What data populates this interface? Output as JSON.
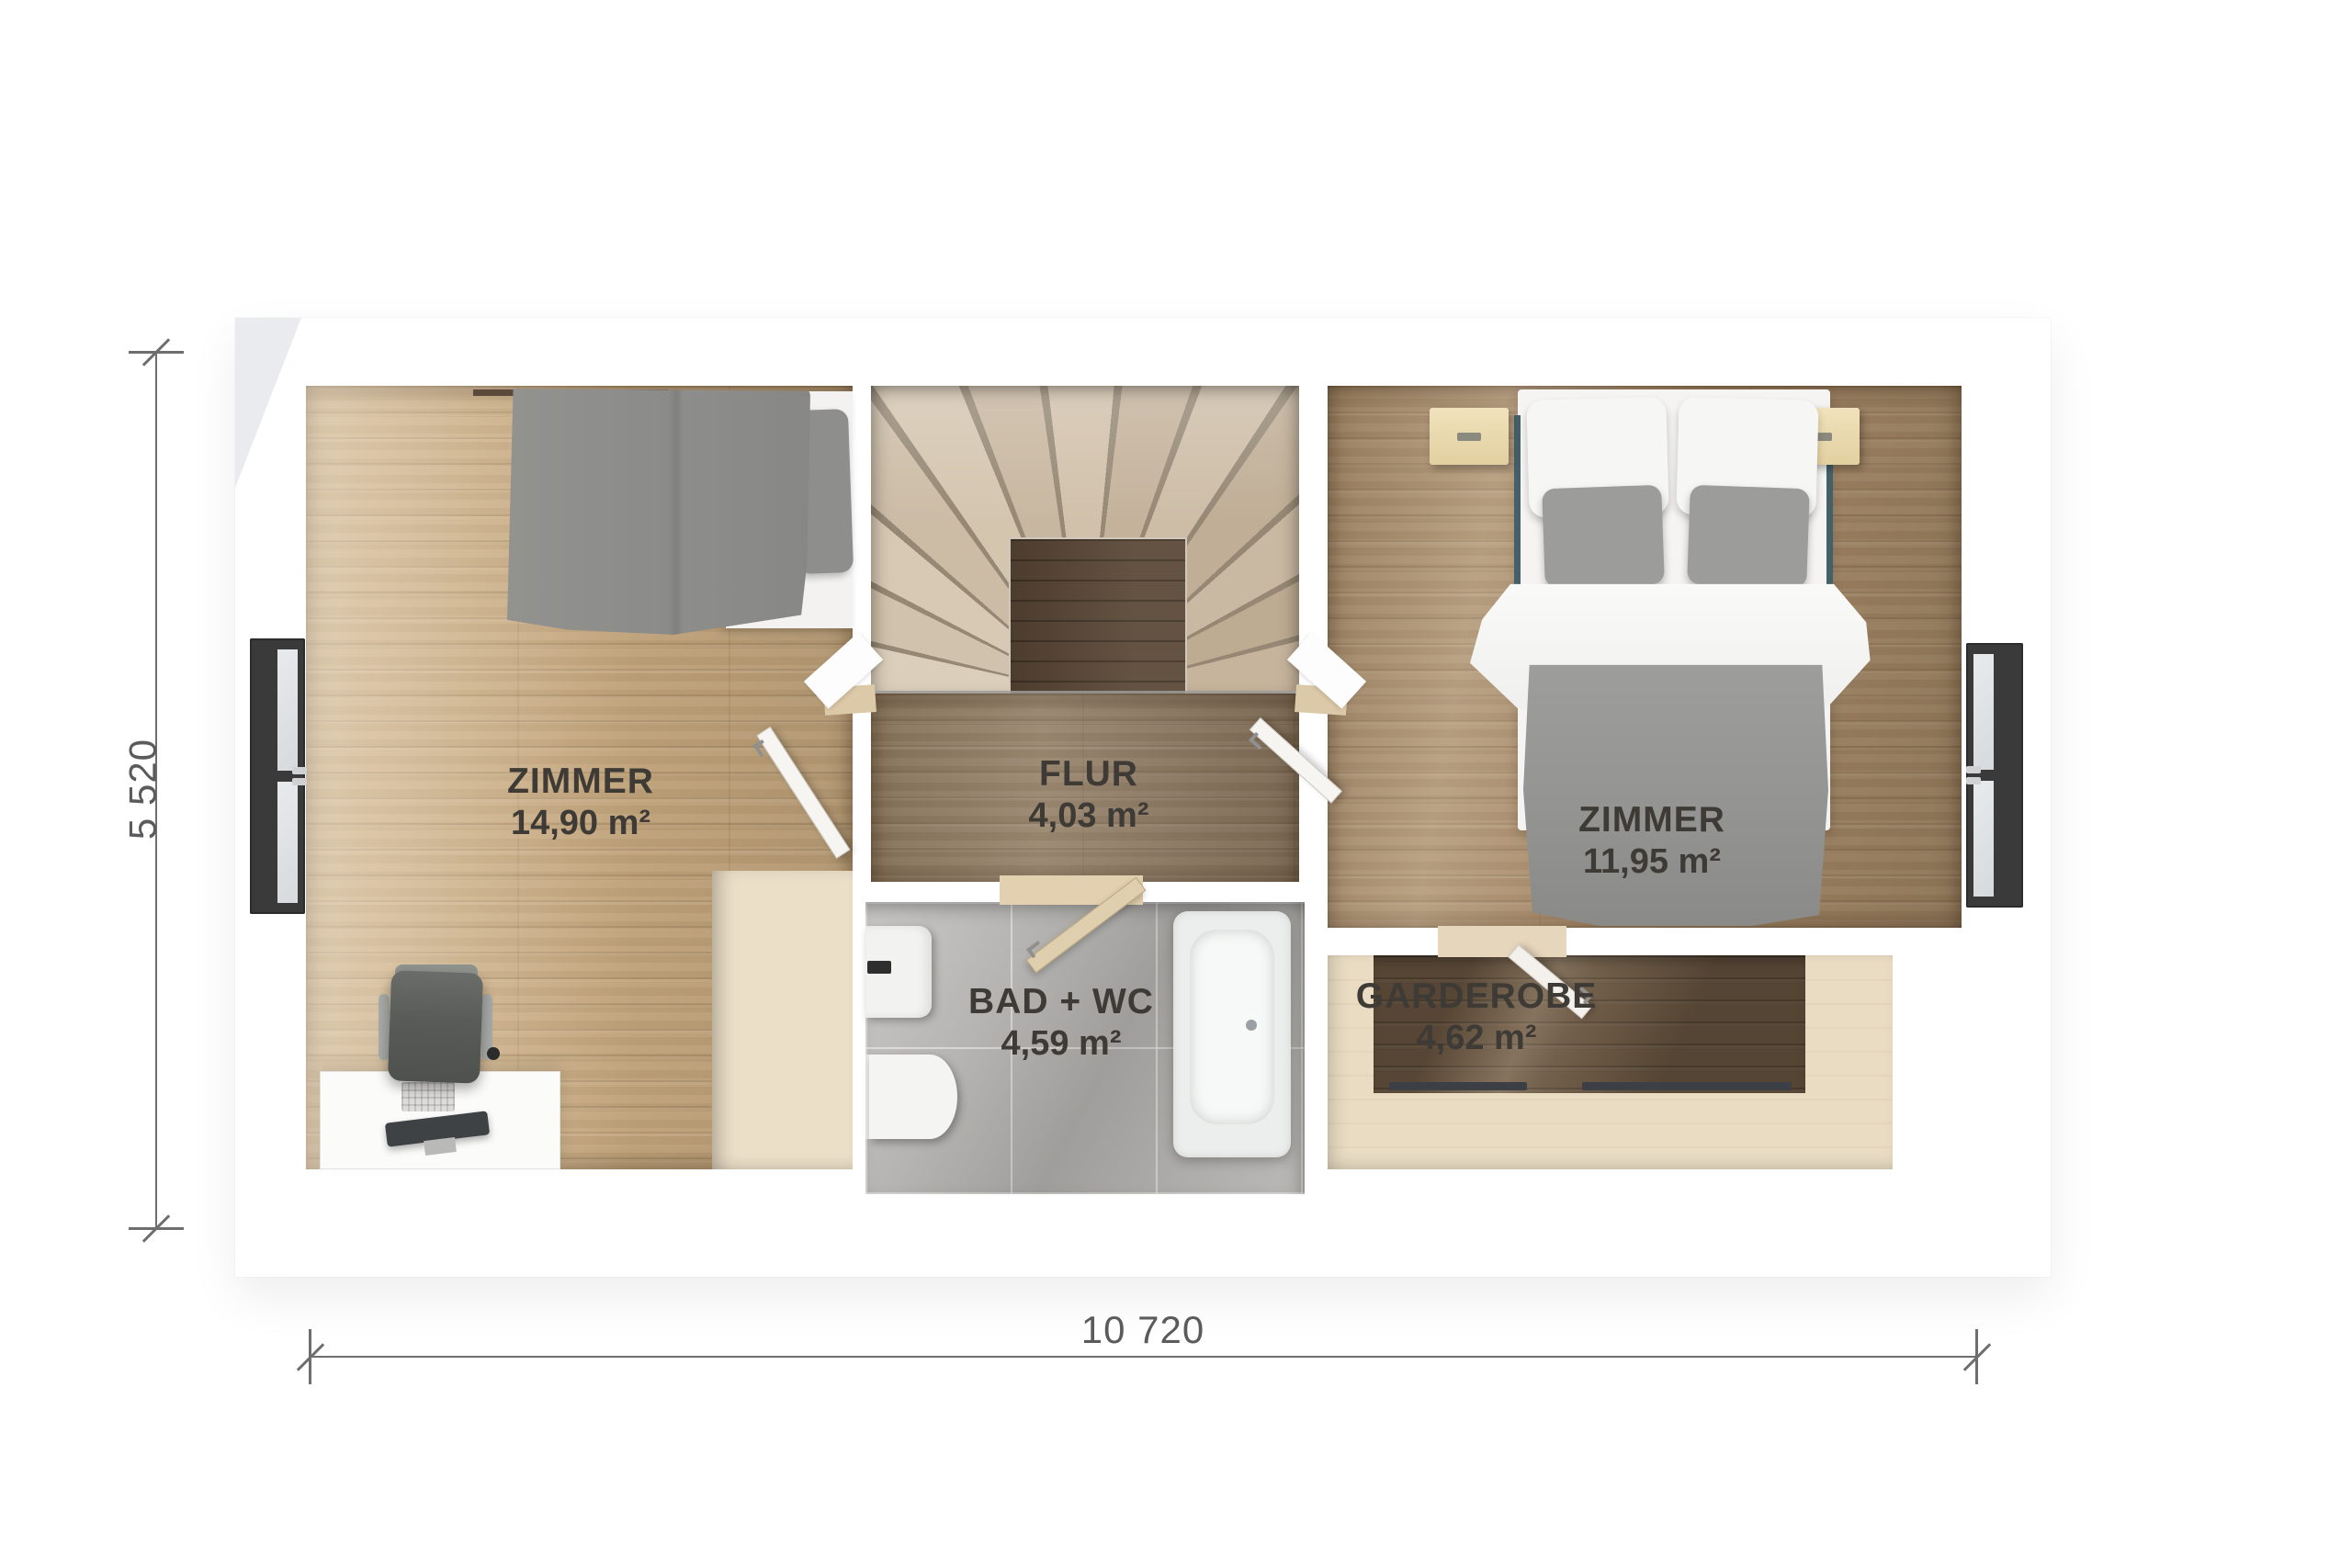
{
  "plan": {
    "title": "Obergeschoss Grundriss",
    "rooms": [
      {
        "key": "zimmer_left",
        "name": "ZIMMER",
        "area": "14,90 m²"
      },
      {
        "key": "flur",
        "name": "FLUR",
        "area": "4,03 m²"
      },
      {
        "key": "zimmer_right",
        "name": "ZIMMER",
        "area": "11,95 m²"
      },
      {
        "key": "bad_wc",
        "name": "BAD + WC",
        "area": "4,59 m²"
      },
      {
        "key": "garderobe",
        "name": "GARDEROBE",
        "area": "4,62 m²"
      }
    ],
    "dimensions": {
      "height": {
        "label": "5 520"
      },
      "width": {
        "label": "10 720"
      }
    },
    "colors": {
      "floor_light_oak": "#c6a87e",
      "floor_medium_oak": "#a98b68",
      "floor_hall": "#8f7a60",
      "floor_dark_walnut": "#63503c",
      "floor_storage_beige": "#e9dcc3",
      "tile_gray": "#b2b0ad",
      "stair_tread": "#d2c4ae",
      "stair_landing": "#5a4736",
      "wall_white": "#ffffff",
      "window_frame": "#3a3a3a",
      "textile_gray": "#93938f",
      "label_text": "#3e3a35",
      "dimension_text": "#5b5b5d"
    }
  }
}
